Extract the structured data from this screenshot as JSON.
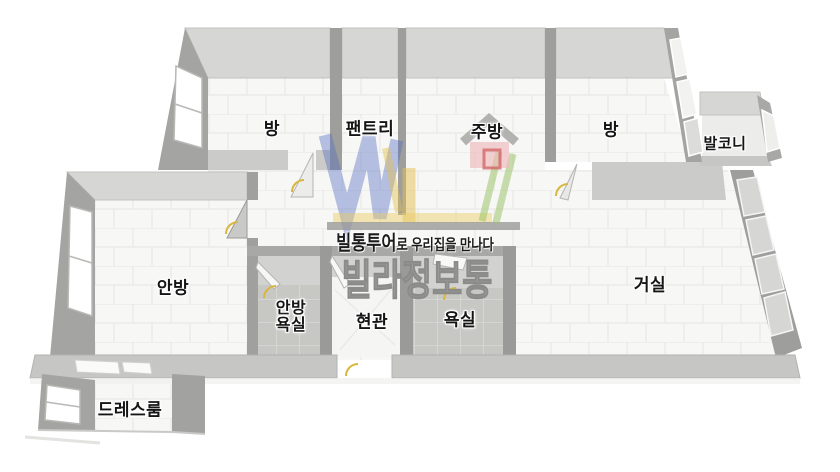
{
  "image_type": "3d-floorplan",
  "rooms": [
    {
      "id": "room-top-left",
      "label": "방"
    },
    {
      "id": "pantry",
      "label": "팬트리"
    },
    {
      "id": "kitchen",
      "label": "주방"
    },
    {
      "id": "room-top-right",
      "label": "방"
    },
    {
      "id": "balcony",
      "label": "발코니"
    },
    {
      "id": "master-bedroom",
      "label": "안방"
    },
    {
      "id": "master-bathroom",
      "label": "안방 욕실",
      "line1": "안방",
      "line2": "욕실"
    },
    {
      "id": "entrance",
      "label": "현관"
    },
    {
      "id": "bathroom",
      "label": "욕실"
    },
    {
      "id": "living-room",
      "label": "거실"
    },
    {
      "id": "dress-room",
      "label": "드레스룸"
    }
  ],
  "watermark": {
    "tagline_bold": "빌통투어",
    "tagline_rest": "로 우리집을 만나다",
    "brand": "빌라정보통",
    "logo_colors": {
      "blue": "#4f68c0",
      "yellow": "#e3c050",
      "green": "#9cc46a",
      "house_body": "#eeb8ba",
      "house_door": "#d06060",
      "roof": "#9b9b99",
      "underline": "#9a9a98"
    }
  },
  "floorplan_colors": {
    "wall_side": "#a4a4a2",
    "wall_face_light": "#d6d6d4",
    "wall_band": "#c6c6c4",
    "floor": "#f7f7f5",
    "bath_tile": "#c9c9c6",
    "door_marker_yellow": "#d9b63e"
  }
}
